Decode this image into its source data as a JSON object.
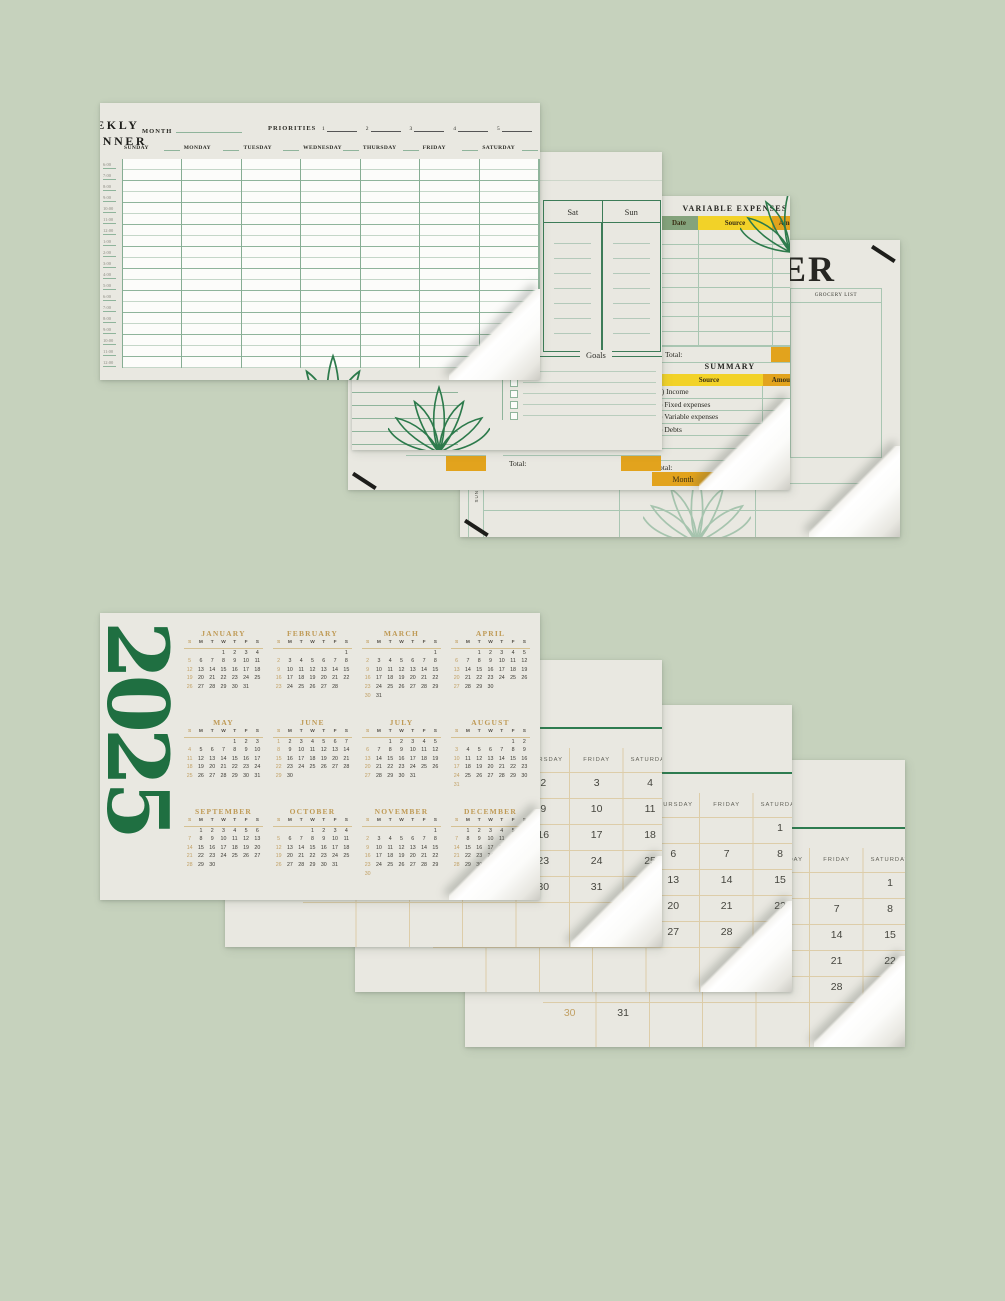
{
  "colors": {
    "bg": "#c6d2bd",
    "paper": "#e9e8e1",
    "paper_white": "#fcfcfa",
    "green_dark": "#1f6f41",
    "green_line": "#8fb49b",
    "green_border": "#3d7c58",
    "green_rule": "#2e7c50",
    "gold": "#bf9a55",
    "gold_num": "#c2a165",
    "tan_line": "#ddcda9",
    "yellow": "#f2d228",
    "orange": "#e2a31d",
    "cell_green": "#84a37c",
    "teal": "#a9c6b2"
  },
  "weekly_planner": {
    "title": "WEEKLY\nPLANNER",
    "month_label": "MONTH",
    "priorities_label": "PRIORITIES",
    "priority_numbers": [
      "1",
      "2",
      "3",
      "4",
      "5"
    ],
    "day_headers": [
      "SUNDAY",
      "MONDAY",
      "TUESDAY",
      "WEDNESDAY",
      "THURSDAY",
      "FRIDAY",
      "SATURDAY"
    ],
    "time_slots": [
      "6:00",
      "7:00",
      "8:00",
      "9:00",
      "10:00",
      "11:00",
      "12:00",
      "1:00",
      "2:00",
      "3:00",
      "4:00",
      "5:00",
      "6:00",
      "7:00",
      "8:00",
      "9:00",
      "10:00",
      "11:00",
      "12:00"
    ]
  },
  "weekend_page": {
    "sat_label": "Sat",
    "sun_label": "Sun",
    "goals_label": "Goals",
    "checkbox_rows": 5,
    "line_rows": 5
  },
  "expenses_page": {
    "ve_title": "VARIABLE EXPENSES",
    "ve_columns": [
      "Date",
      "Source",
      "Amount"
    ],
    "ve_rows": 8,
    "total_label": "Total:",
    "summary_title": "SUMMARY",
    "summary_columns": [
      "Source",
      "Amount"
    ],
    "summary_rows": [
      "(+) Income",
      "(-) Fixed expenses",
      "(-) Variable expenses",
      "(-) Debts"
    ],
    "summary_empty_rows": 2,
    "month_label": "Month"
  },
  "cover_page": {
    "title_fragment": "ER",
    "grocery_list_label": "GROCERY LIST",
    "sun_label": "SUN"
  },
  "year_page": {
    "year": "2025",
    "day_letter_headers": [
      "S",
      "M",
      "T",
      "W",
      "T",
      "F",
      "S"
    ],
    "months": [
      {
        "name": "JANUARY",
        "start": 3,
        "days": 31
      },
      {
        "name": "FEBRUARY",
        "start": 6,
        "days": 28
      },
      {
        "name": "MARCH",
        "start": 6,
        "days": 31
      },
      {
        "name": "APRIL",
        "start": 2,
        "days": 30
      },
      {
        "name": "MAY",
        "start": 4,
        "days": 31
      },
      {
        "name": "JUNE",
        "start": 0,
        "days": 30
      },
      {
        "name": "JULY",
        "start": 2,
        "days": 31
      },
      {
        "name": "AUGUST",
        "start": 5,
        "days": 31
      },
      {
        "name": "SEPTEMBER",
        "start": 1,
        "days": 30
      },
      {
        "name": "OCTOBER",
        "start": 3,
        "days": 31
      },
      {
        "name": "NOVEMBER",
        "start": 6,
        "days": 30
      },
      {
        "name": "DECEMBER",
        "start": 1,
        "days": 31
      }
    ]
  },
  "monthly_day_headers": [
    "SUNDAY",
    "MONDAY",
    "TUESDAY",
    "WEDNESDAY",
    "THURSDAY",
    "FRIDAY",
    "SATURDAY"
  ],
  "monthly_pages": [
    {
      "id": "january",
      "start": 3,
      "days": 31
    },
    {
      "id": "february",
      "start": 6,
      "days": 28
    },
    {
      "id": "march",
      "start": 6,
      "days": 31
    }
  ]
}
